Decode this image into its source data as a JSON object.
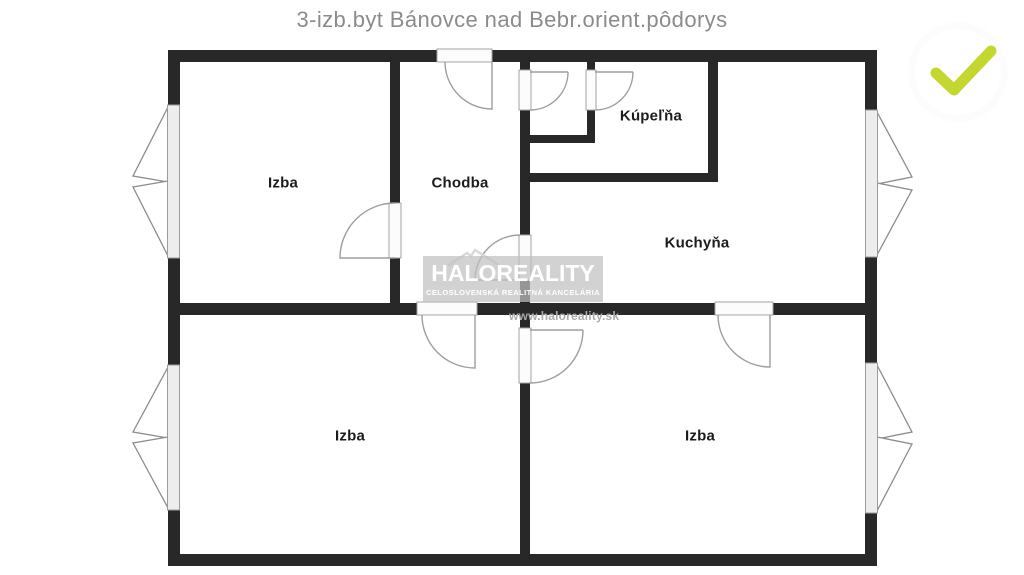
{
  "title": "3-izb.byt Bánovce nad Bebr.orient.pôdorys",
  "rooms": {
    "izba_top_left": "Izba",
    "chodba": "Chodba",
    "kupelna": "Kúpeľňa",
    "kuchyna": "Kuchyňa",
    "izba_bottom_left": "Izba",
    "izba_bottom_right": "Izba"
  },
  "watermark": {
    "brand": "HALOREALITY",
    "tagline": "CELOSLOVENSKÁ REALITNÁ KANCELÁRIA",
    "website": "www.haloreality.sk"
  },
  "badge": {
    "icon": "checkmark-icon",
    "check_color": "#c3d72e"
  },
  "colors": {
    "wall": "#282828",
    "title_text": "#8b8b8b",
    "label_text": "#1c1c1c",
    "door_window_lines": "#9e9e9e",
    "watermark_bg": "#c9c9c9",
    "watermark_text": "#ffffff",
    "website_text": "#ababab"
  }
}
